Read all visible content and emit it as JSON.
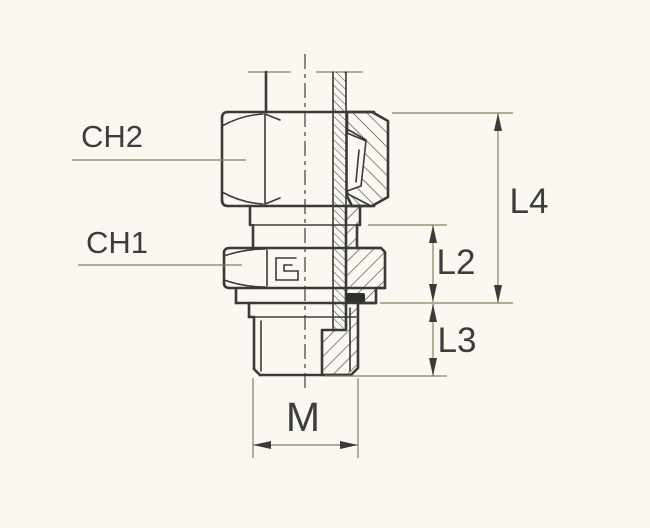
{
  "drawing": {
    "type": "technical-drawing",
    "subject": "male stud coupling cross-section",
    "background_color": "#faf8f1",
    "outline_color": "#3a3a3a",
    "thin_line_color": "#8a7f63",
    "text_color": "#3d3d3d",
    "seal_color": "#2f2f2f",
    "labels": {
      "ch2": "CH2",
      "ch1": "CH1",
      "l4": "L4",
      "l2": "L2",
      "l3": "L3",
      "m": "M"
    },
    "callouts": [
      {
        "id": "ch2",
        "meaning": "wrench size of coupling nut",
        "side": "left"
      },
      {
        "id": "ch1",
        "meaning": "wrench size of body hex",
        "side": "left"
      },
      {
        "id": "l4",
        "meaning": "overall height nut top to thread start",
        "side": "right"
      },
      {
        "id": "l2",
        "meaning": "body shoulder height",
        "side": "right"
      },
      {
        "id": "l3",
        "meaning": "stud thread length",
        "side": "right"
      },
      {
        "id": "m",
        "meaning": "stud thread diameter",
        "side": "bottom"
      }
    ]
  }
}
